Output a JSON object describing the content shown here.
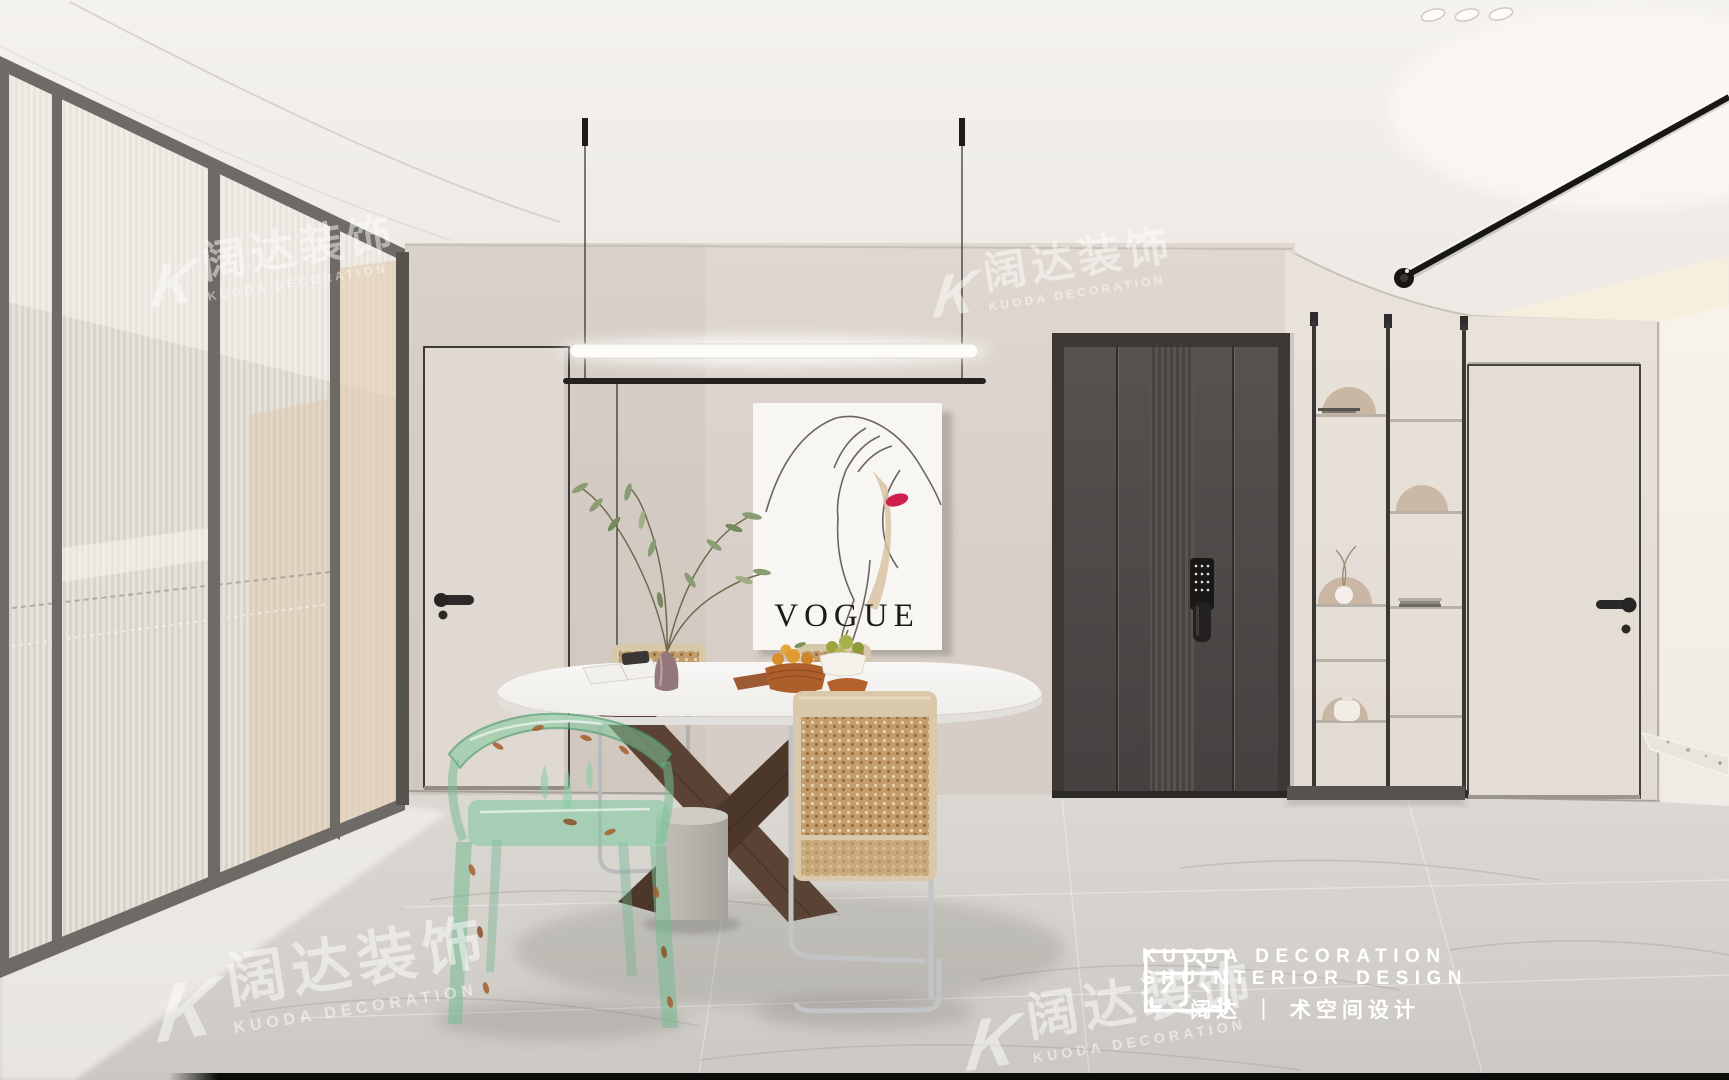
{
  "brand": {
    "watermark_k": "K",
    "watermark_cn": "阔达装饰",
    "watermark_en": "KUODA DECORATION",
    "logo_line1": "KUODA DECORATION",
    "logo_line2": "SHU NTERIOR DESIGN",
    "logo_line3": "阔达 ｜ 术空间设计"
  },
  "poster": {
    "title": "VOGUE"
  },
  "colors": {
    "ceiling": "#f1eeea",
    "back_wall": "#dcd4cc",
    "right_wall": "#e7e0d8",
    "bright_wall": "#f3efe9",
    "floor": "#d6d3ce",
    "dark_door": "#4e4a47",
    "poster_white": "#f7f6f3",
    "accent_lips": "#cf1f4c",
    "chair_green": "#8fd0a8",
    "rattan": "#c29a6c",
    "wood_base": "#5a4334",
    "chrome": "#c6c8ca",
    "brand_white": "#ffffff"
  }
}
